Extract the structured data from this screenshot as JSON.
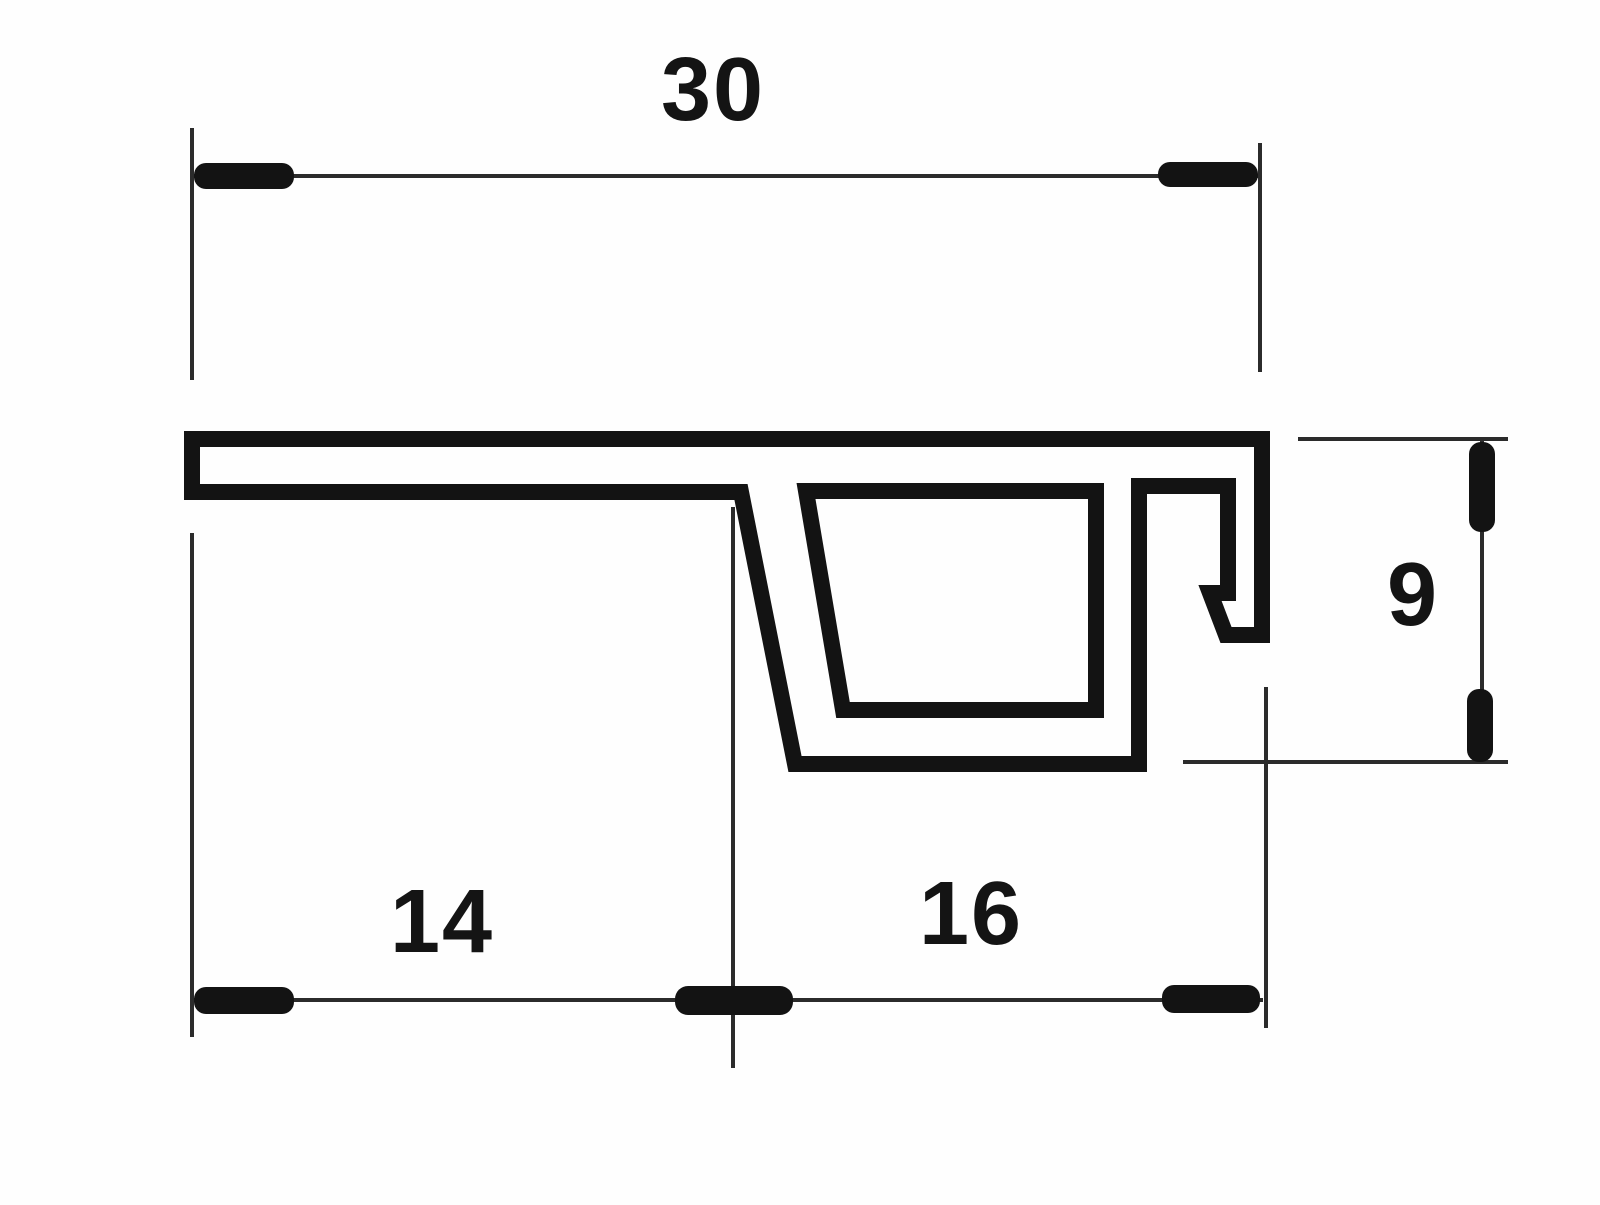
{
  "drawing": {
    "kind": "profile-cross-section",
    "colors": {
      "background": "#fefefe",
      "profile_line": "#131313",
      "thin_line": "#2b2b2b",
      "text": "#141414"
    },
    "dimensions": {
      "top_width": "30",
      "bottom_left_width": "14",
      "bottom_right_width": "16",
      "right_height": "9"
    }
  }
}
